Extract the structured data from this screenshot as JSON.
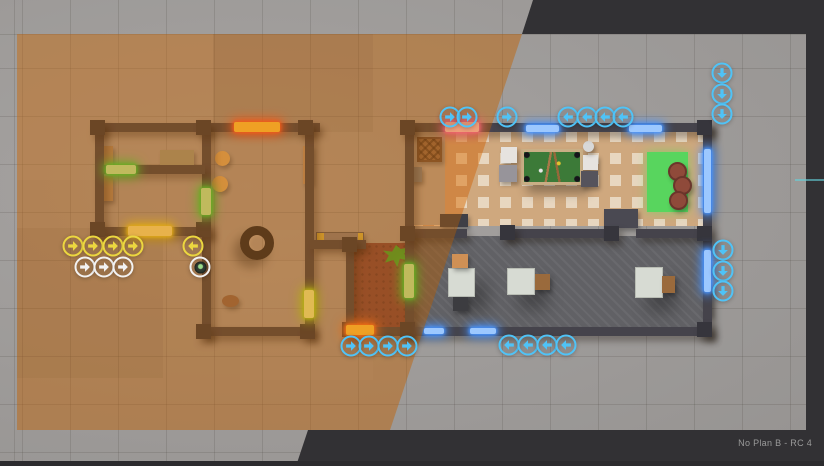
{
  "app": {
    "version_label": "No Plan B - RC 4"
  },
  "palette": {
    "letterbox": "#323134",
    "ground": "#a19e9c",
    "wall": "#45434b",
    "sepia_zone_ground": "#b5824d",
    "squad_yellow": "#ecd73f",
    "squad_white": "#f2f2f2",
    "squad_blue": "#4fc3f7",
    "door_red_glow": "#ff5a26",
    "door_pink_glow": "#ff6ad0",
    "door_green_glow": "#35e83a",
    "window_blue": "#4f9bff"
  },
  "scene": {
    "patches": [
      {
        "x": 17,
        "y": 34,
        "w": 196,
        "h": 146,
        "color": "rgba(255,255,255,0.05)"
      },
      {
        "x": 213,
        "y": 34,
        "w": 160,
        "h": 98,
        "color": "rgba(0,0,0,0.05)"
      },
      {
        "x": 17,
        "y": 228,
        "w": 146,
        "h": 150,
        "color": "rgba(0,0,0,0.05)"
      },
      {
        "x": 240,
        "y": 260,
        "w": 133,
        "h": 120,
        "color": "rgba(255,255,255,0.04)"
      },
      {
        "x": 213,
        "y": 230,
        "w": 96,
        "h": 96,
        "color": "rgba(255,255,255,0.04)"
      }
    ],
    "floors": [
      {
        "name": "wood-lounge-floor",
        "kind": "floor-herringbone",
        "x": 412,
        "y": 131,
        "w": 293,
        "h": 95
      },
      {
        "name": "entry-rug",
        "kind": "floor-rugentry",
        "x": 412,
        "y": 132,
        "w": 33,
        "h": 93
      },
      {
        "name": "concrete-room-floor",
        "kind": "floor-concrete",
        "x": 412,
        "y": 236,
        "w": 293,
        "h": 92
      },
      {
        "name": "hallway-carpet",
        "kind": "floor-carpet",
        "x": 352,
        "y": 243,
        "w": 55,
        "h": 84
      }
    ],
    "walls": [
      {
        "x": 95,
        "y": 123,
        "w": 225,
        "h": 9
      },
      {
        "x": 95,
        "y": 123,
        "w": 9,
        "h": 113
      },
      {
        "x": 95,
        "y": 227,
        "w": 116,
        "h": 9
      },
      {
        "x": 202,
        "y": 123,
        "w": 9,
        "h": 213
      },
      {
        "x": 104,
        "y": 165,
        "w": 101,
        "h": 9
      },
      {
        "x": 305,
        "y": 123,
        "w": 9,
        "h": 213
      },
      {
        "x": 202,
        "y": 327,
        "w": 112,
        "h": 9
      },
      {
        "x": 310,
        "y": 240,
        "w": 56,
        "h": 9
      },
      {
        "x": 346,
        "y": 240,
        "w": 8,
        "h": 95
      },
      {
        "x": 346,
        "y": 327,
        "w": 66,
        "h": 9
      },
      {
        "x": 405,
        "y": 123,
        "w": 307,
        "h": 9
      },
      {
        "x": 405,
        "y": 123,
        "w": 9,
        "h": 213
      },
      {
        "x": 703,
        "y": 123,
        "w": 9,
        "h": 213
      },
      {
        "x": 405,
        "y": 327,
        "w": 307,
        "h": 9
      },
      {
        "x": 412,
        "y": 229,
        "w": 55,
        "h": 9
      },
      {
        "x": 502,
        "y": 229,
        "w": 106,
        "h": 9
      },
      {
        "x": 636,
        "y": 229,
        "w": 68,
        "h": 9
      }
    ],
    "posts": [
      [
        90,
        120
      ],
      [
        196,
        120
      ],
      [
        298,
        120
      ],
      [
        400,
        120
      ],
      [
        697,
        120
      ],
      [
        90,
        222
      ],
      [
        196,
        222
      ],
      [
        342,
        237
      ],
      [
        400,
        226
      ],
      [
        500,
        225
      ],
      [
        604,
        226
      ],
      [
        697,
        226
      ],
      [
        196,
        324
      ],
      [
        300,
        324
      ],
      [
        342,
        322
      ],
      [
        400,
        322
      ],
      [
        697,
        322
      ]
    ],
    "windows": [
      {
        "x": 526,
        "y": 125,
        "w": 33,
        "h": 7
      },
      {
        "x": 629,
        "y": 125,
        "w": 33,
        "h": 7
      },
      {
        "x": 704,
        "y": 149,
        "w": 7,
        "h": 64
      },
      {
        "x": 704,
        "y": 250,
        "w": 7,
        "h": 42
      },
      {
        "x": 424,
        "y": 328,
        "w": 20,
        "h": 6
      },
      {
        "x": 470,
        "y": 328,
        "w": 26,
        "h": 6
      }
    ],
    "doors": [
      {
        "name": "door-red-north",
        "x": 234,
        "y": 122,
        "w": 46,
        "h": 10,
        "glow": "#ff5a26",
        "core": "#ffd23a"
      },
      {
        "name": "door-pink-north",
        "x": 445,
        "y": 122,
        "w": 34,
        "h": 10,
        "glow": "#ff6ad0",
        "core": "#ffd0e8"
      },
      {
        "name": "door-yellow-west",
        "x": 128,
        "y": 226,
        "w": 44,
        "h": 10,
        "glow": "#e8e020",
        "core": "#f6f28a"
      },
      {
        "name": "door-green-interior",
        "x": 106,
        "y": 165,
        "w": 30,
        "h": 9,
        "glow": "#35e83a",
        "core": "#b8ffb0"
      },
      {
        "name": "door-green-mid",
        "x": 201,
        "y": 188,
        "w": 10,
        "h": 27,
        "glow": "#35e83a",
        "core": "#b8ffb0"
      },
      {
        "name": "door-green-east",
        "x": 304,
        "y": 290,
        "w": 10,
        "h": 28,
        "glow": "#a8e818",
        "core": "#e8ff9a"
      },
      {
        "name": "door-green-hall",
        "x": 404,
        "y": 264,
        "w": 10,
        "h": 34,
        "glow": "#35e83a",
        "core": "#b8ffb0"
      },
      {
        "name": "door-orange-south",
        "x": 346,
        "y": 325,
        "w": 28,
        "h": 10,
        "glow": "#ff7a1a",
        "core": "#ffd23a"
      }
    ],
    "furniture": [
      {
        "name": "wall-shelf",
        "x": 96,
        "y": 146,
        "w": 17,
        "h": 22,
        "color": "#a8906a"
      },
      {
        "name": "wall-shelf",
        "x": 96,
        "y": 176,
        "w": 17,
        "h": 25,
        "color": "#a8906a"
      },
      {
        "name": "sideboard",
        "x": 160,
        "y": 150,
        "w": 34,
        "h": 17,
        "color": "#9aa08a"
      },
      {
        "name": "round-stool",
        "kind": "circle",
        "x": 215,
        "y": 151,
        "w": 15,
        "h": 15,
        "color": "#d8b46a"
      },
      {
        "name": "round-stool",
        "kind": "circle",
        "x": 212,
        "y": 176,
        "w": 16,
        "h": 16,
        "color": "#d8b46a"
      },
      {
        "name": "wooden-door",
        "x": 303,
        "y": 146,
        "w": 10,
        "h": 38,
        "color": "#b49b77",
        "inter": "true"
      },
      {
        "name": "tire",
        "kind": "tire",
        "x": 240,
        "y": 226,
        "w": 34,
        "h": 34
      },
      {
        "name": "rock",
        "kind": "circle",
        "x": 222,
        "y": 295,
        "w": 17,
        "h": 12,
        "color": "#8a6a52"
      },
      {
        "name": "bench",
        "kind": "bench",
        "x": 316,
        "y": 232,
        "w": 48,
        "h": 14
      },
      {
        "name": "wicker-basket",
        "kind": "basket",
        "x": 417,
        "y": 137,
        "w": 25,
        "h": 25
      },
      {
        "name": "crate",
        "x": 407,
        "y": 167,
        "w": 15,
        "h": 15,
        "color": "#7d8a99"
      },
      {
        "name": "pool-table",
        "kind": "pool-table",
        "x": 521,
        "y": 149,
        "w": 62,
        "h": 36
      },
      {
        "name": "white-stool",
        "x": 501,
        "y": 147,
        "w": 16,
        "h": 16,
        "color": "#e6e3df"
      },
      {
        "name": "cabinet",
        "x": 499,
        "y": 165,
        "w": 18,
        "h": 17,
        "color": "#97949a"
      },
      {
        "name": "white-stool",
        "x": 583,
        "y": 155,
        "w": 15,
        "h": 15,
        "color": "#e6e3df"
      },
      {
        "name": "cabinet",
        "x": 581,
        "y": 171,
        "w": 17,
        "h": 16,
        "color": "#55535c"
      },
      {
        "name": "floor-lamp",
        "kind": "circle",
        "x": 583,
        "y": 141,
        "w": 11,
        "h": 11,
        "color": "#d8d8d8"
      },
      {
        "name": "green-rug",
        "kind": "rug",
        "x": 647,
        "y": 152,
        "w": 41,
        "h": 60,
        "color": "#58d55e"
      },
      {
        "name": "pouf",
        "kind": "pouf",
        "x": 668,
        "y": 162,
        "w": 19,
        "h": 19,
        "color": "#8f4a3a"
      },
      {
        "name": "pouf",
        "kind": "pouf",
        "x": 673,
        "y": 176,
        "w": 19,
        "h": 19,
        "color": "#8f4a3a"
      },
      {
        "name": "pouf",
        "kind": "pouf",
        "x": 669,
        "y": 191,
        "w": 19,
        "h": 19,
        "color": "#8f4a3a"
      },
      {
        "name": "wall-cabinet",
        "x": 440,
        "y": 214,
        "w": 28,
        "h": 13,
        "color": "#3f3f46"
      },
      {
        "name": "wall-cabinet",
        "x": 604,
        "y": 209,
        "w": 34,
        "h": 19,
        "color": "#4a4952"
      },
      {
        "name": "square-table",
        "kind": "table",
        "x": 448,
        "y": 268,
        "w": 27,
        "h": 29,
        "color": "#d7dbd3"
      },
      {
        "name": "square-table",
        "kind": "table",
        "x": 507,
        "y": 268,
        "w": 28,
        "h": 27,
        "color": "#d7dbd3"
      },
      {
        "name": "square-table",
        "kind": "table",
        "x": 635,
        "y": 267,
        "w": 28,
        "h": 31,
        "color": "#d7dbd3"
      },
      {
        "name": "chair",
        "x": 452,
        "y": 254,
        "w": 16,
        "h": 14,
        "color": "#cf9055"
      },
      {
        "name": "chair",
        "x": 453,
        "y": 297,
        "w": 15,
        "h": 14,
        "color": "#3c3c40"
      },
      {
        "name": "chair",
        "x": 535,
        "y": 274,
        "w": 15,
        "h": 16,
        "color": "#9a6a3c"
      },
      {
        "name": "chair",
        "x": 662,
        "y": 276,
        "w": 13,
        "h": 17,
        "color": "#9a6a3c"
      },
      {
        "name": "plant",
        "kind": "plant",
        "x": 383,
        "y": 245,
        "w": 26,
        "h": 22
      },
      {
        "name": "gray-door",
        "x": 704,
        "y": 284,
        "w": 8,
        "h": 32,
        "color": "#8e8e92",
        "inter": "true"
      }
    ],
    "badges": [
      {
        "group": "squad-yellow-path",
        "color": "#ecd73f",
        "items": [
          {
            "x": 73,
            "y": 246,
            "dir": "r"
          },
          {
            "x": 93,
            "y": 246,
            "dir": "r"
          },
          {
            "x": 113,
            "y": 246,
            "dir": "r"
          },
          {
            "x": 133,
            "y": 246,
            "dir": "r"
          },
          {
            "x": 193,
            "y": 246,
            "dir": "l"
          }
        ]
      },
      {
        "group": "squad-white-path",
        "color": "#f2f2f2",
        "items": [
          {
            "x": 85,
            "y": 267,
            "dir": "r"
          },
          {
            "x": 104,
            "y": 267,
            "dir": "r"
          },
          {
            "x": 123,
            "y": 267,
            "dir": "r"
          },
          {
            "x": 200,
            "y": 267,
            "kind": "gadget"
          }
        ]
      },
      {
        "group": "squad-blue-path",
        "color": "#4fc3f7",
        "items": [
          {
            "x": 450,
            "y": 117,
            "dir": "r"
          },
          {
            "x": 467,
            "y": 117,
            "dir": "r"
          },
          {
            "x": 507,
            "y": 117,
            "dir": "r"
          },
          {
            "x": 568,
            "y": 117,
            "dir": "l"
          },
          {
            "x": 587,
            "y": 117,
            "dir": "l"
          },
          {
            "x": 605,
            "y": 117,
            "dir": "l"
          },
          {
            "x": 623,
            "y": 117,
            "dir": "l"
          },
          {
            "x": 722,
            "y": 73,
            "dir": "d"
          },
          {
            "x": 722,
            "y": 94,
            "dir": "d"
          },
          {
            "x": 722,
            "y": 114,
            "dir": "d"
          },
          {
            "x": 723,
            "y": 250,
            "dir": "d"
          },
          {
            "x": 723,
            "y": 271,
            "dir": "d"
          },
          {
            "x": 723,
            "y": 291,
            "dir": "d"
          },
          {
            "x": 351,
            "y": 346,
            "dir": "r"
          },
          {
            "x": 369,
            "y": 346,
            "dir": "r"
          },
          {
            "x": 388,
            "y": 346,
            "dir": "r"
          },
          {
            "x": 407,
            "y": 346,
            "dir": "r"
          },
          {
            "x": 509,
            "y": 345,
            "dir": "l"
          },
          {
            "x": 528,
            "y": 345,
            "dir": "l"
          },
          {
            "x": 547,
            "y": 345,
            "dir": "l"
          },
          {
            "x": 566,
            "y": 345,
            "dir": "l"
          }
        ]
      }
    ]
  }
}
